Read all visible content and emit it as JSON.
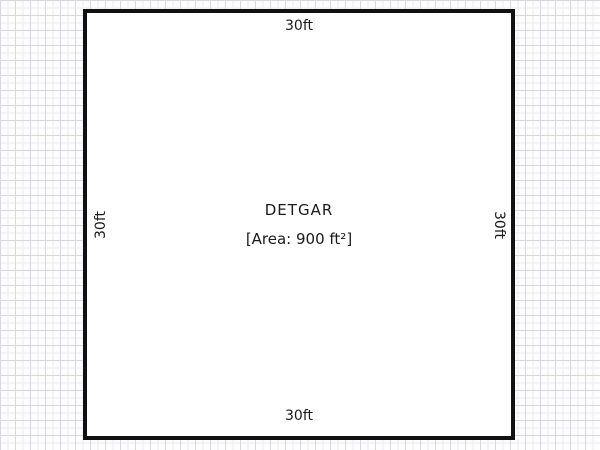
{
  "room": {
    "name": "DETGAR",
    "area_label": "[Area: 900 ft²]",
    "dimensions": {
      "top": "30ft",
      "right": "30ft",
      "bottom": "30ft",
      "left": "30ft"
    }
  },
  "colors": {
    "wall": "#111111",
    "room_fill": "#ffffff",
    "grid_major": "#d7d7e1",
    "grid_minor": "#ececf2",
    "text": "#1a1a1a"
  }
}
